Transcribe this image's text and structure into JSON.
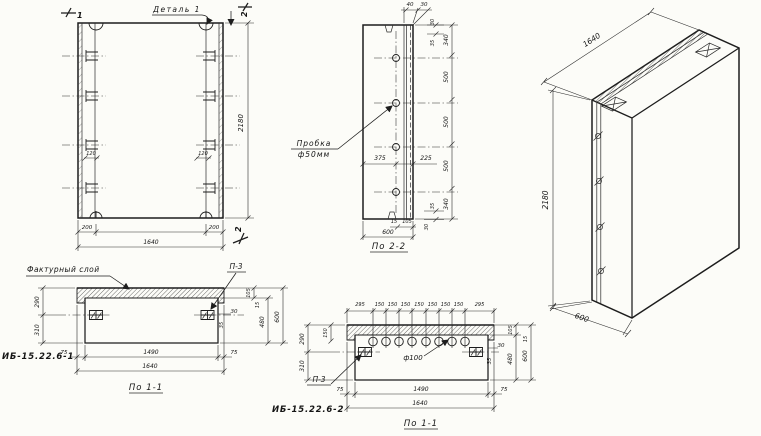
{
  "front": {
    "detail_label": "Деталь 1",
    "cut_mark_1": "1",
    "cut_mark_2_top": "2",
    "cut_mark_2_bottom": "2",
    "dim_height": "2180",
    "dim_end_left": "200",
    "dim_end_right": "200",
    "dim_width": "1640",
    "dim_anchor_left": "120",
    "dim_anchor_right": "120"
  },
  "section22": {
    "title": "По 2-2",
    "plug_label_1": "Пробка",
    "plug_label_2": "ф50мм",
    "dim_top_40": "40",
    "dim_top_30": "30",
    "corner_top": [
      "30",
      "35"
    ],
    "chain": [
      "340",
      "500",
      "500",
      "500",
      "340"
    ],
    "corner_bottom": [
      "35",
      "30"
    ],
    "dim_hole_left": "375",
    "dim_hole_right": "225",
    "dim_bottom_15": "15",
    "dim_bottom_105": "105",
    "dim_depth": "600"
  },
  "iso": {
    "dim_length": "1640",
    "dim_height": "2180",
    "dim_depth": "600"
  },
  "section11a": {
    "product_mark": "ИБ-15.22.6-1",
    "title": "По 1-1",
    "facing_layer_label": "Фактурный слой",
    "embed_label": "П-3",
    "dim_290": "290",
    "dim_310": "310",
    "dim_75_left": "75",
    "dim_1490": "1490",
    "dim_75_right": "75",
    "dim_width": "1640",
    "dim_105": "105",
    "dim_15": "15",
    "dim_30": "30",
    "dim_35": "35",
    "dim_480": "480",
    "dim_600": "600"
  },
  "section11b": {
    "product_mark": "ИБ-15.22.6-2",
    "title": "По 1-1",
    "embed_label": "П-3",
    "hole_label": "ф100",
    "top_chain": [
      "295",
      "150",
      "150",
      "150",
      "150",
      "150",
      "150",
      "150",
      "295"
    ],
    "dim_150": "150",
    "dim_290": "290",
    "dim_310": "310",
    "dim_75_left": "75",
    "dim_1490": "1490",
    "dim_75_right": "75",
    "dim_width": "1640",
    "dim_105": "105",
    "dim_15": "15",
    "dim_30": "30",
    "dim_35": "35",
    "dim_480": "480",
    "dim_600": "600"
  }
}
